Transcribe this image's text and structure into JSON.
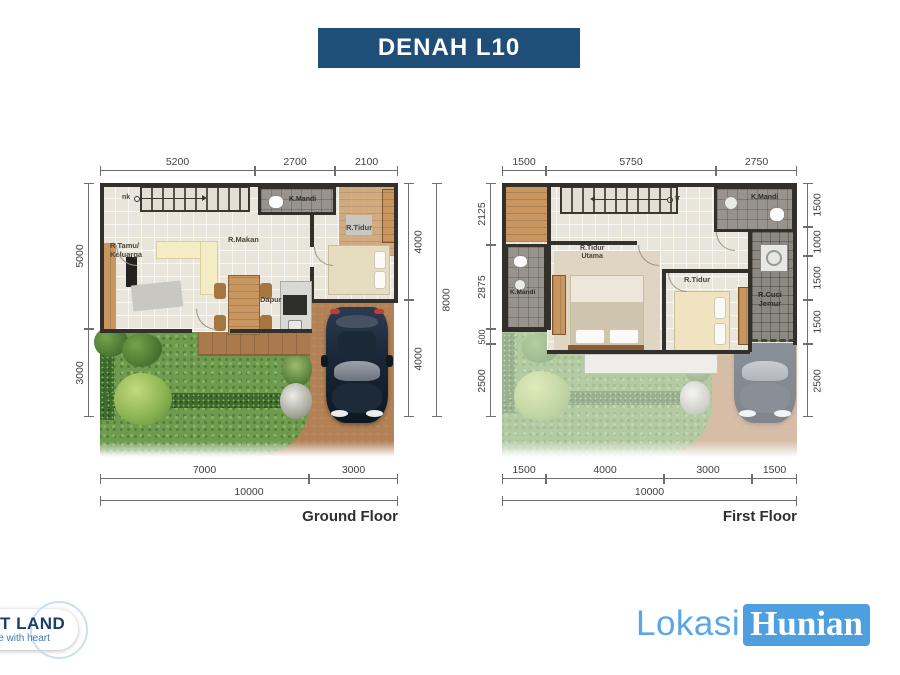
{
  "title": "DENAH L10",
  "ground_floor": {
    "name": "Ground Floor",
    "stair_label": "nk",
    "rooms": {
      "tamu1": "R Tamu/",
      "tamu2": "Keluarga",
      "makan": "R.Makan",
      "kmandi": "K.Mandi",
      "tidur": "R.Tidur",
      "dapur": "Dapur"
    },
    "dims": {
      "top": [
        "5200",
        "2700",
        "2100"
      ],
      "left": [
        "5000",
        "3000"
      ],
      "right_inner": [
        "4000",
        "4000"
      ],
      "right_outer": [
        "8000"
      ],
      "bottom_inner": [
        "7000",
        "3000"
      ],
      "bottom_outer": [
        "10000"
      ]
    }
  },
  "first_floor": {
    "name": "First Floor",
    "stair_label": "tr",
    "rooms": {
      "kmandi_top": "K.Mandi",
      "kmandi_left": "K.Mandi",
      "tidur_utama1": "R.Tidur",
      "tidur_utama2": "Utama",
      "tidur": "R.Tidur",
      "cuci1": "R.Cuci",
      "cuci2": "Jemur"
    },
    "dims": {
      "top": [
        "1500",
        "5750",
        "2750"
      ],
      "left": [
        "2125",
        "2875",
        "500",
        "2500"
      ],
      "right": [
        "1500",
        "1000",
        "1500",
        "1500",
        "2500"
      ],
      "bottom_inner": [
        "1500",
        "4000",
        "3000",
        "1500"
      ],
      "bottom_outer": [
        "10000"
      ]
    }
  },
  "branding": {
    "developer_logo": {
      "line1": "T LAND",
      "line2": "le with heart"
    },
    "publisher_logo": {
      "part1": "Lokasi",
      "part2": "Hunian"
    }
  },
  "colors": {
    "title_bg": "#1F4E79",
    "publisher_blue": "#4D9FE0",
    "lokasi_text": "#5CA6E6",
    "developer_navy": "#1C3E6B",
    "wall": "#332F2A",
    "grass": "#6F9B4E",
    "driveway": "#B28156",
    "car_body": "#1C2A3C"
  }
}
